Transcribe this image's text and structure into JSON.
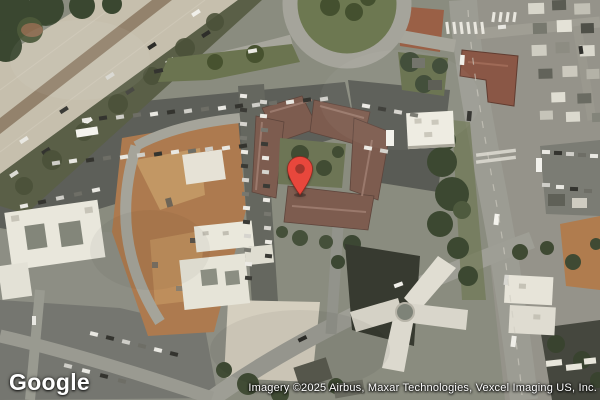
{
  "map": {
    "view": "satellite",
    "logo_text": "Google",
    "attribution_text": "Imagery ©2025 Airbus, Maxar Technologies, Vexcel Imaging US, Inc.",
    "marker": {
      "color": "#E8473C",
      "inner_dot_color": "#A0362C"
    }
  }
}
